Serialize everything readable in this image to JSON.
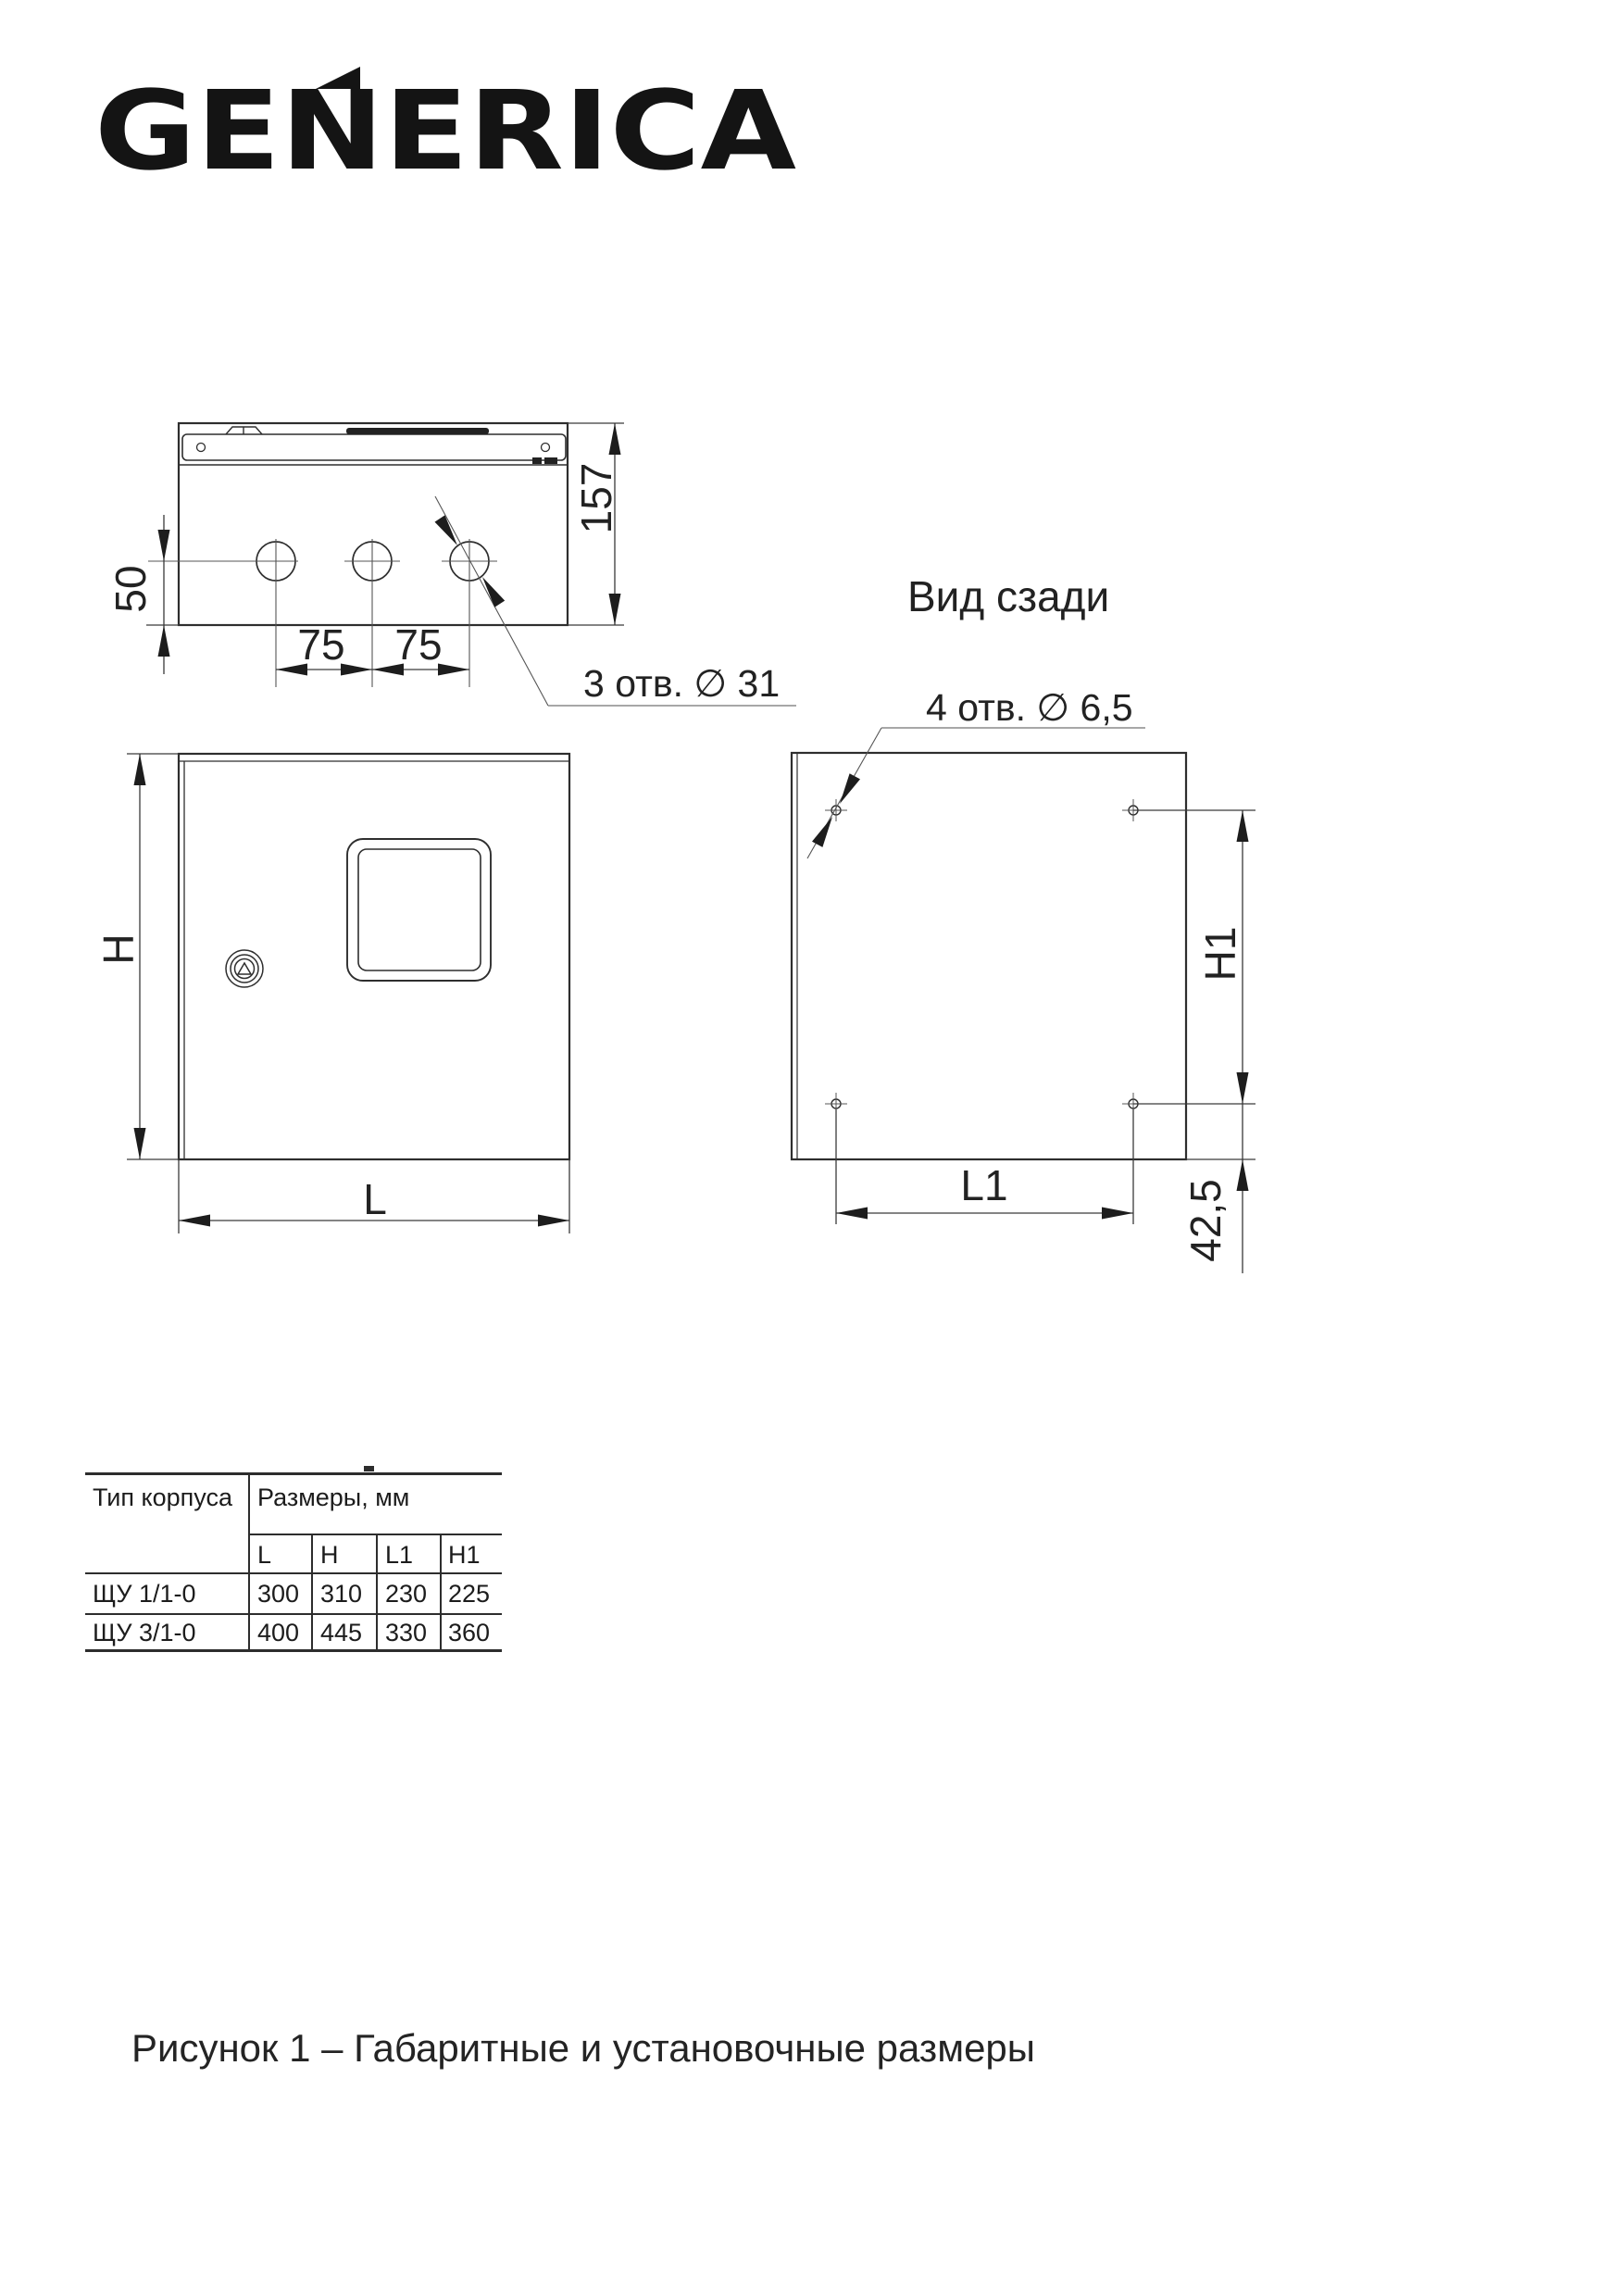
{
  "logo": {
    "text": "GENERICA"
  },
  "views": {
    "top": {
      "dim_depth": "157",
      "dim_hole_offset": "50",
      "dim_spacing_1": "75",
      "dim_spacing_2": "75",
      "holes_note": "3 отв. ∅ 31"
    },
    "front": {
      "dim_height": "H",
      "dim_width": "L"
    },
    "rear": {
      "title": "Вид сзади",
      "holes_note": "4 отв. ∅ 6,5",
      "dim_height": "H1",
      "dim_width": "L1",
      "dim_bottom_offset": "42,5"
    }
  },
  "table": {
    "type_header": "Тип корпуса",
    "dims_header": "Размеры, мм",
    "sub_headers": [
      "L",
      "H",
      "L1",
      "H1"
    ],
    "rows": [
      {
        "type": "ЩУ 1/1-0",
        "values": [
          "300",
          "310",
          "230",
          "225"
        ]
      },
      {
        "type": "ЩУ 3/1-0",
        "values": [
          "400",
          "445",
          "330",
          "360"
        ]
      }
    ]
  },
  "caption": "Рисунок 1 – Габаритные и установочные размеры"
}
